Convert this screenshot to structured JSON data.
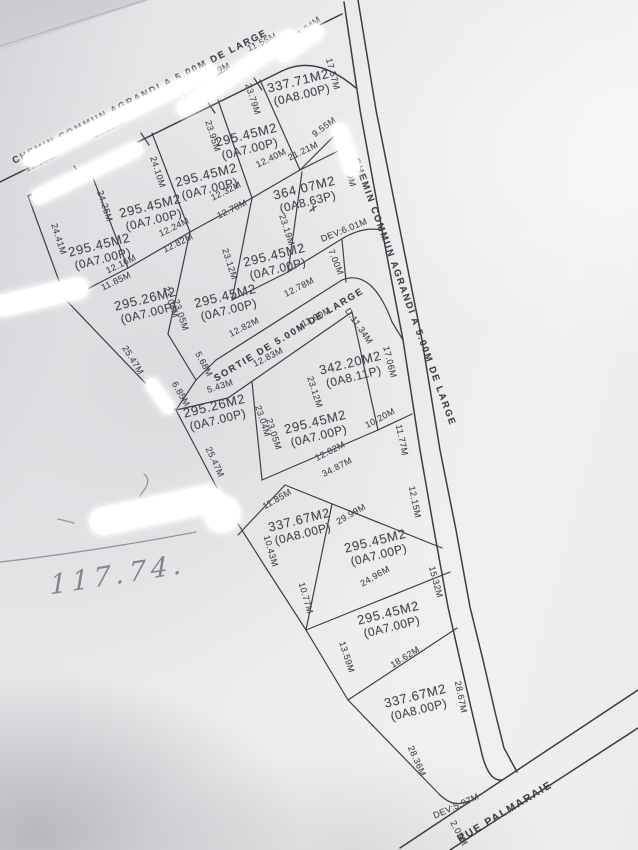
{
  "document": {
    "kind": "photographed land subdivision survey plan",
    "labels": [
      {
        "kind": "road",
        "t": "CHEMIN COMMUN AGRANDI A 5.00M DE LARGE",
        "x": 140,
        "y": 97,
        "r": -27
      },
      {
        "kind": "road",
        "t": "CHEMIN COMMUN AGRANDI A 5.00M DE LARGE",
        "x": 404,
        "y": 292,
        "r": 70
      },
      {
        "kind": "road",
        "t": "SORTIE DE 5.00M DE LARGE",
        "x": 289,
        "y": 335,
        "r": -31
      },
      {
        "kind": "road",
        "t": "RUE PALMARAIE",
        "x": 505,
        "y": 812,
        "r": -31,
        "fs": 10.5
      },
      {
        "kind": "lot",
        "area": "337.71M2",
        "oa": "(0A8.00P)",
        "x": 300,
        "y": 88,
        "r": -14
      },
      {
        "kind": "lot",
        "area": "295.45M2",
        "oa": "(0A7.00P)",
        "x": 248,
        "y": 142,
        "r": -14
      },
      {
        "kind": "lot",
        "area": "295.45M2",
        "oa": "(0A7.00P)",
        "x": 208,
        "y": 182,
        "r": -14
      },
      {
        "kind": "lot",
        "area": "295.45M2",
        "oa": "(0A7.00P)",
        "x": 152,
        "y": 213,
        "r": -14
      },
      {
        "kind": "lot",
        "area": "295.45M2",
        "oa": "(0A7.00P)",
        "x": 101,
        "y": 252,
        "r": -14
      },
      {
        "kind": "lot",
        "area": "364.07M2",
        "oa": "(0A8.63P)",
        "x": 306,
        "y": 195,
        "r": -14
      },
      {
        "kind": "lot",
        "area": "295.45M2",
        "oa": "(0A7.00P)",
        "x": 276,
        "y": 262,
        "r": -14
      },
      {
        "kind": "lot",
        "area": "295.26M2",
        "oa": "(0A7.00P)",
        "x": 147,
        "y": 306,
        "r": -14
      },
      {
        "kind": "lot",
        "area": "295.45M2",
        "oa": "(0A7.00P)",
        "x": 227,
        "y": 303,
        "r": -14
      },
      {
        "kind": "lot",
        "area": "342.20M2",
        "oa": "(0A8.11P)",
        "x": 352,
        "y": 370,
        "r": -14
      },
      {
        "kind": "lot",
        "area": "295.26M2",
        "oa": "(0A7.00P)",
        "x": 216,
        "y": 413,
        "r": -14
      },
      {
        "kind": "lot",
        "area": "295.45M2",
        "oa": "(0A7.00P)",
        "x": 317,
        "y": 429,
        "r": -14
      },
      {
        "kind": "lot",
        "area": "337.67M2",
        "oa": "(0A8.00P)",
        "x": 301,
        "y": 527,
        "r": -14
      },
      {
        "kind": "lot",
        "area": "295.45M2",
        "oa": "(0A7.00P)",
        "x": 377,
        "y": 548,
        "r": -14
      },
      {
        "kind": "lot",
        "area": "295.45M2",
        "oa": "(0A7.00P)",
        "x": 390,
        "y": 620,
        "r": -14
      },
      {
        "kind": "lot",
        "area": "337.67M2",
        "oa": "(0A8.00P)",
        "x": 417,
        "y": 703,
        "r": -14
      },
      {
        "kind": "dim",
        "t": "12.16M",
        "x": 40,
        "y": 162,
        "r": -26
      },
      {
        "kind": "dim",
        "t": "12.23M",
        "x": 108,
        "y": 128,
        "r": -26
      },
      {
        "kind": "dim",
        "t": "12.31M",
        "x": 164,
        "y": 99,
        "r": -26
      },
      {
        "kind": "dim",
        "t": "12.39M",
        "x": 215,
        "y": 72,
        "r": -26
      },
      {
        "kind": "dim",
        "t": "11.55M",
        "x": 262,
        "y": 42,
        "r": -26
      },
      {
        "kind": "dim",
        "t": "11.24M",
        "x": 307,
        "y": 28,
        "r": -38
      },
      {
        "kind": "dim",
        "t": "17.57M",
        "x": 333,
        "y": 74,
        "r": 75
      },
      {
        "kind": "dim",
        "t": "23.79M",
        "x": 253,
        "y": 99,
        "r": 72
      },
      {
        "kind": "dim",
        "t": "23.95M",
        "x": 213,
        "y": 136,
        "r": 72
      },
      {
        "kind": "dim",
        "t": "24.10M",
        "x": 158,
        "y": 172,
        "r": 72
      },
      {
        "kind": "dim",
        "t": "24.25M",
        "x": 105,
        "y": 206,
        "r": 72
      },
      {
        "kind": "dim",
        "t": "24.41M",
        "x": 59,
        "y": 239,
        "r": 72
      },
      {
        "kind": "dim",
        "t": "9.55M",
        "x": 324,
        "y": 127,
        "r": -36
      },
      {
        "kind": "dim",
        "t": "21.21M",
        "x": 303,
        "y": 151,
        "r": -26
      },
      {
        "kind": "dim",
        "t": "12.40M",
        "x": 271,
        "y": 158,
        "r": -26
      },
      {
        "kind": "dim",
        "t": "22.69M",
        "x": 349,
        "y": 171,
        "r": 75
      },
      {
        "kind": "dim",
        "t": "12.32M",
        "x": 226,
        "y": 191,
        "r": -26
      },
      {
        "kind": "dim",
        "t": "12.78M",
        "x": 232,
        "y": 209,
        "r": -26
      },
      {
        "kind": "dim",
        "t": "12.24M",
        "x": 174,
        "y": 227,
        "r": -26
      },
      {
        "kind": "dim",
        "t": "12.82M",
        "x": 178,
        "y": 243,
        "r": -26
      },
      {
        "kind": "dim",
        "t": "12.16M",
        "x": 121,
        "y": 264,
        "r": -26
      },
      {
        "kind": "dim",
        "t": "11.85M",
        "x": 116,
        "y": 281,
        "r": -26
      },
      {
        "kind": "dim",
        "t": "23.19M",
        "x": 287,
        "y": 230,
        "r": 72
      },
      {
        "kind": "dim",
        "t": "23.12M",
        "x": 230,
        "y": 264,
        "r": 72
      },
      {
        "kind": "dim",
        "t": "23.04M",
        "x": 171,
        "y": 302,
        "r": 72
      },
      {
        "kind": "dim",
        "t": "23.05M",
        "x": 181,
        "y": 315,
        "r": 72
      },
      {
        "kind": "dim",
        "t": "7.00M",
        "x": 336,
        "y": 262,
        "r": 68
      },
      {
        "kind": "dim",
        "t": "DEV:6.01M",
        "x": 344,
        "y": 230,
        "r": -22
      },
      {
        "kind": "dim",
        "t": "12.78M",
        "x": 299,
        "y": 287,
        "r": -27
      },
      {
        "kind": "dim",
        "t": "12.82M",
        "x": 244,
        "y": 327,
        "r": -27
      },
      {
        "kind": "dim",
        "t": "12.83M",
        "x": 268,
        "y": 357,
        "r": -27
      },
      {
        "kind": "dim",
        "t": "11.90M",
        "x": 316,
        "y": 317,
        "r": -27
      },
      {
        "kind": "dim",
        "t": "D:11.34M",
        "x": 359,
        "y": 326,
        "r": 55
      },
      {
        "kind": "dim",
        "t": "25.47M",
        "x": 133,
        "y": 360,
        "r": 58
      },
      {
        "kind": "dim",
        "t": "5.68M",
        "x": 204,
        "y": 364,
        "r": 62
      },
      {
        "kind": "dim",
        "t": "6.85M",
        "x": 181,
        "y": 394,
        "r": 60
      },
      {
        "kind": "dim",
        "t": "5.43M",
        "x": 220,
        "y": 386,
        "r": -18
      },
      {
        "kind": "dim",
        "t": "25.47M",
        "x": 215,
        "y": 462,
        "r": 65
      },
      {
        "kind": "dim",
        "t": "17.06M",
        "x": 390,
        "y": 362,
        "r": 76
      },
      {
        "kind": "dim",
        "t": "10.20M",
        "x": 380,
        "y": 418,
        "r": -28
      },
      {
        "kind": "dim",
        "t": "23.12M",
        "x": 315,
        "y": 392,
        "r": 72
      },
      {
        "kind": "dim",
        "t": "11.77M",
        "x": 402,
        "y": 440,
        "r": 78
      },
      {
        "kind": "dim",
        "t": "12.82M",
        "x": 330,
        "y": 451,
        "r": -27
      },
      {
        "kind": "dim",
        "t": "34.87M",
        "x": 337,
        "y": 467,
        "r": -27
      },
      {
        "kind": "dim",
        "t": "23.04M",
        "x": 263,
        "y": 421,
        "r": 72
      },
      {
        "kind": "dim",
        "t": "23.05M",
        "x": 274,
        "y": 434,
        "r": 72
      },
      {
        "kind": "dim",
        "t": "12.15M",
        "x": 415,
        "y": 502,
        "r": 78
      },
      {
        "kind": "dim",
        "t": "11.85M",
        "x": 277,
        "y": 499,
        "r": -30
      },
      {
        "kind": "dim",
        "t": "29.99M",
        "x": 351,
        "y": 514,
        "r": -30
      },
      {
        "kind": "dim",
        "t": "10.43M",
        "x": 271,
        "y": 551,
        "r": 74
      },
      {
        "kind": "dim",
        "t": "24.96M",
        "x": 375,
        "y": 576,
        "r": -30
      },
      {
        "kind": "dim",
        "t": "15.32M",
        "x": 436,
        "y": 582,
        "r": 75
      },
      {
        "kind": "dim",
        "t": "10.77M",
        "x": 306,
        "y": 598,
        "r": 74
      },
      {
        "kind": "dim",
        "t": "13.59M",
        "x": 347,
        "y": 657,
        "r": 72
      },
      {
        "kind": "dim",
        "t": "18.62M",
        "x": 405,
        "y": 657,
        "r": -32
      },
      {
        "kind": "dim",
        "t": "28.67M",
        "x": 461,
        "y": 697,
        "r": 78
      },
      {
        "kind": "dim",
        "t": "28.36M",
        "x": 417,
        "y": 761,
        "r": 66
      },
      {
        "kind": "dim",
        "t": "DEV:5.97M",
        "x": 456,
        "y": 806,
        "r": -24
      },
      {
        "kind": "dim",
        "t": "2.05M",
        "x": 459,
        "y": 833,
        "r": 62
      },
      {
        "kind": "mark",
        "t": "✗",
        "x": 313,
        "y": 210,
        "r": 15
      },
      {
        "kind": "hand",
        "t": "117.74.",
        "x": 118,
        "y": 575,
        "r": -9
      }
    ]
  }
}
